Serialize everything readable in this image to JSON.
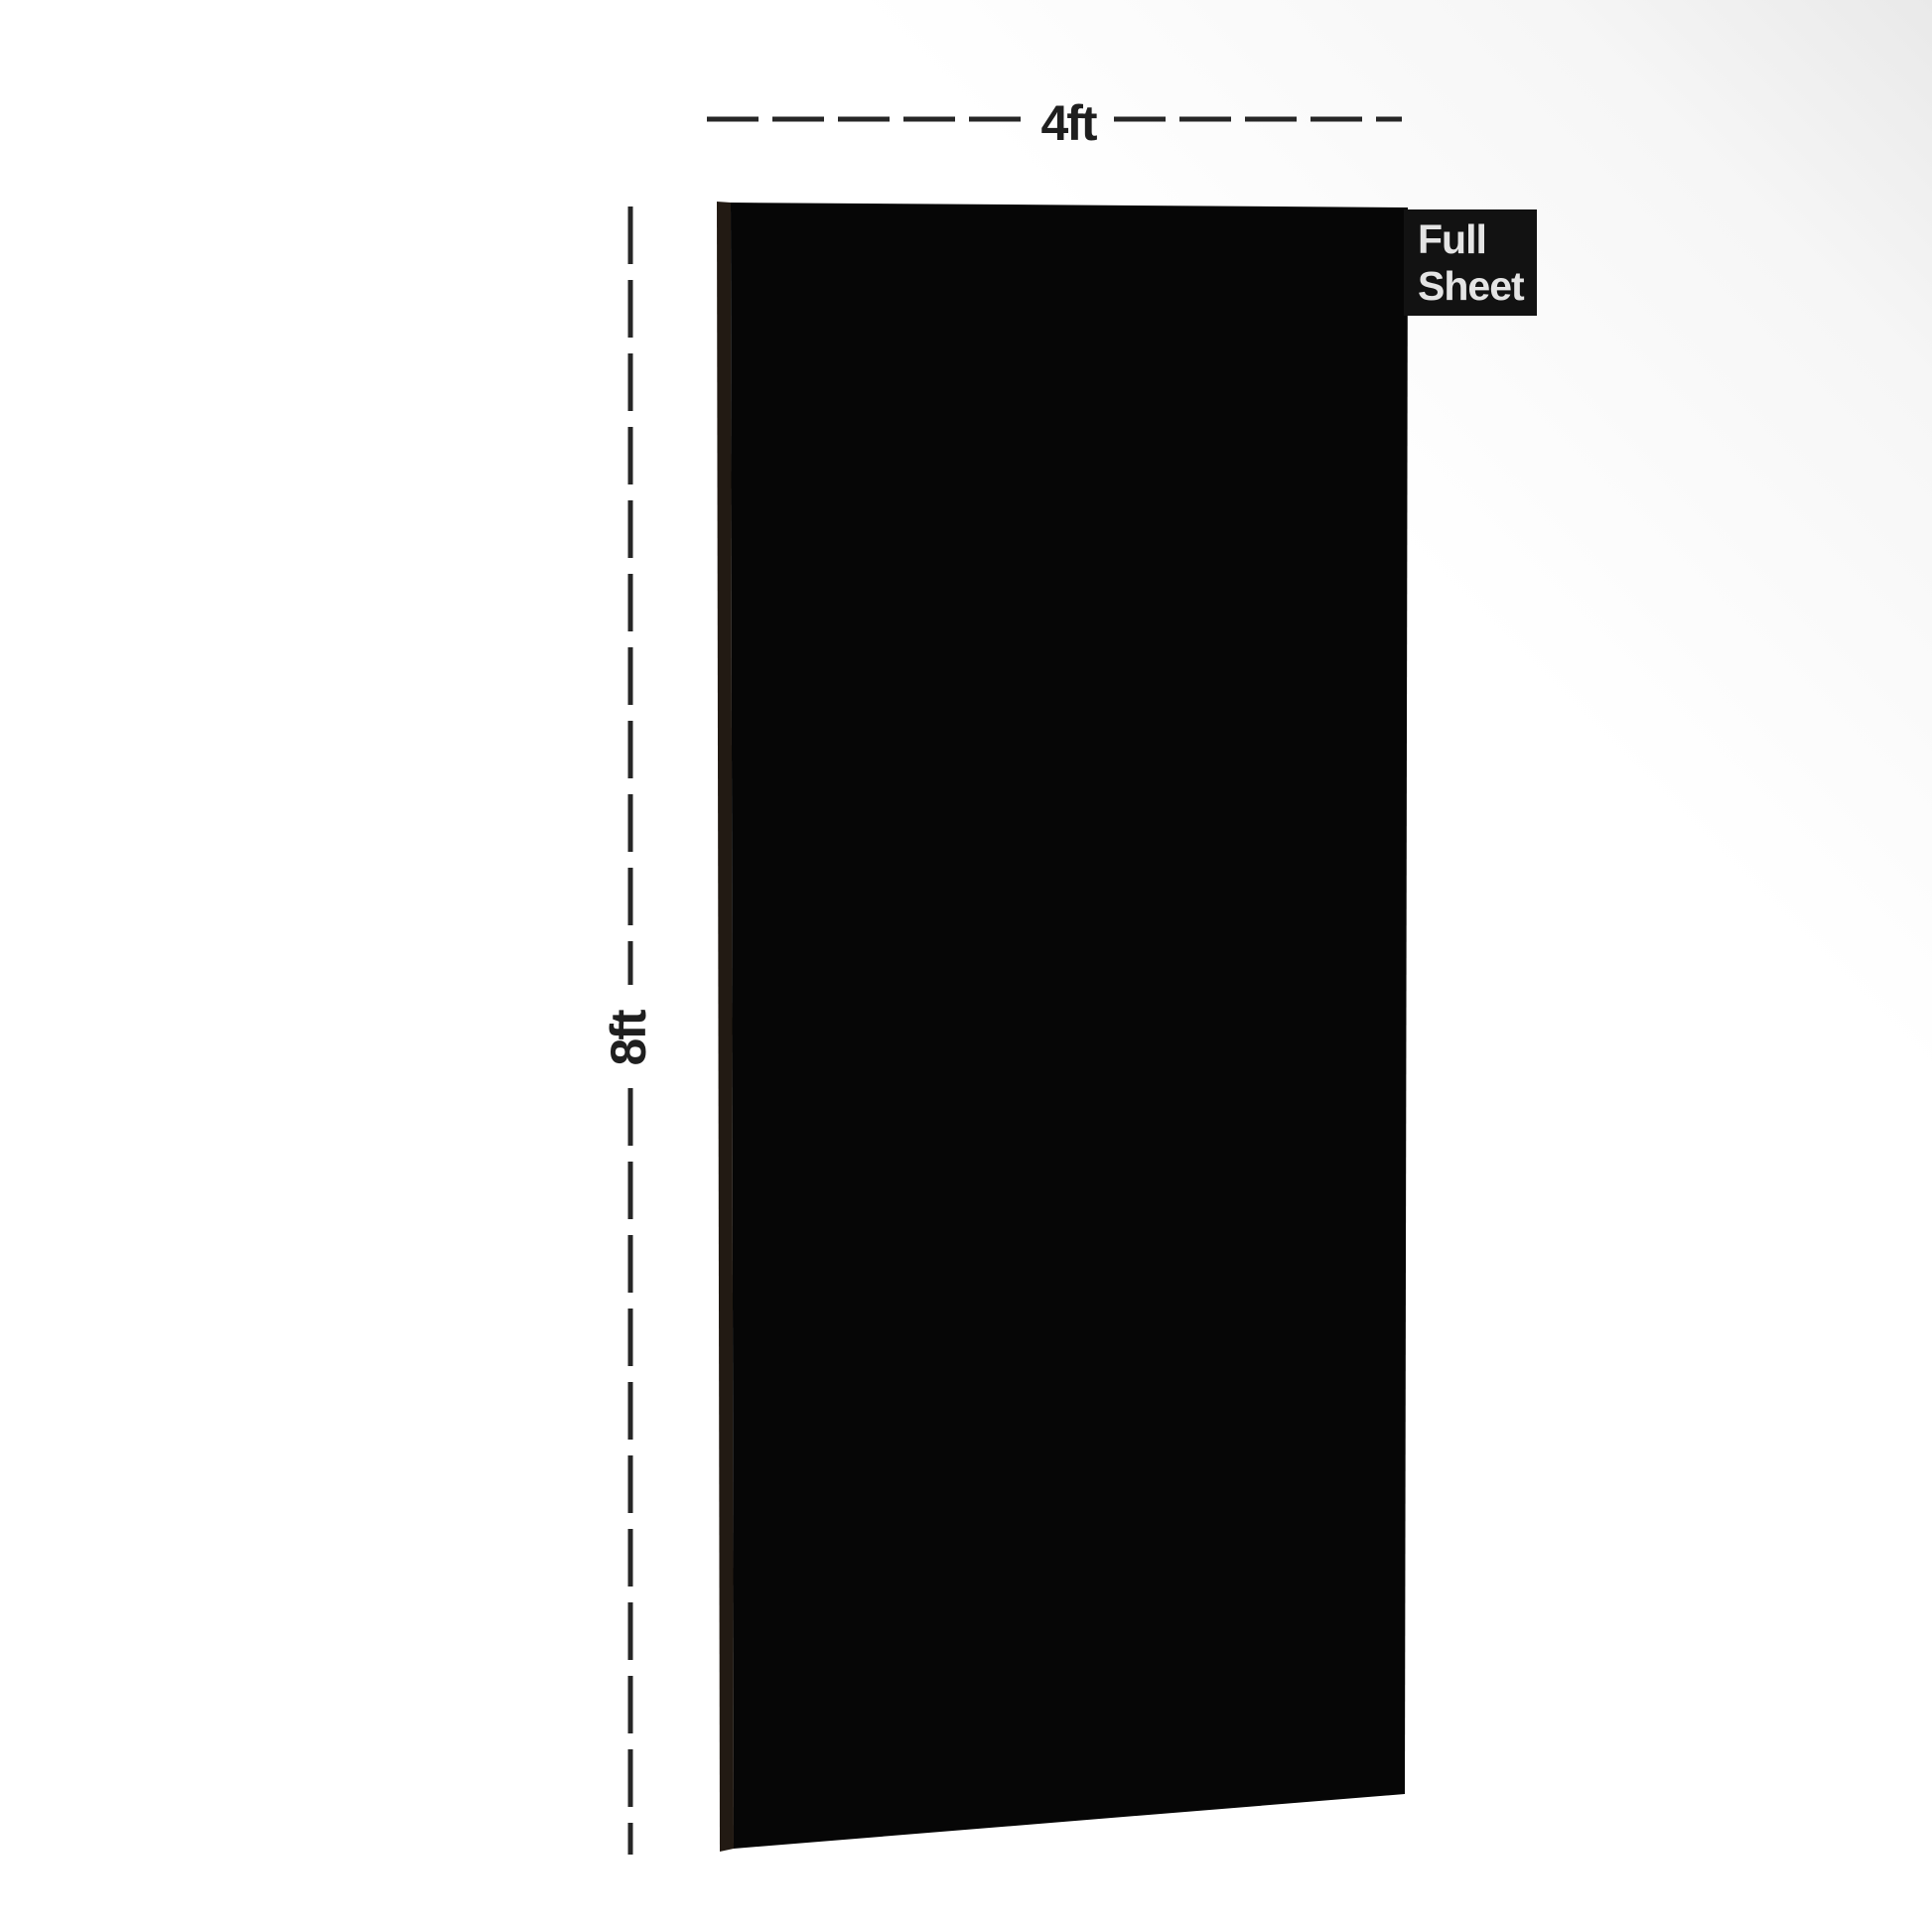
{
  "labels": {
    "width": "4ft",
    "height": "8ft"
  },
  "badge": {
    "line1": "Full",
    "line2": "Sheet"
  },
  "colors": {
    "sheet_face": "#060606",
    "sheet_edge": "#221a13",
    "badge_bg": "#121212",
    "badge_text": "#e4e4e4",
    "dimension_line": "#262626",
    "dimension_text": "#1f1f1f",
    "background": "#ffffff",
    "background_tint": "#e9e9e9"
  }
}
